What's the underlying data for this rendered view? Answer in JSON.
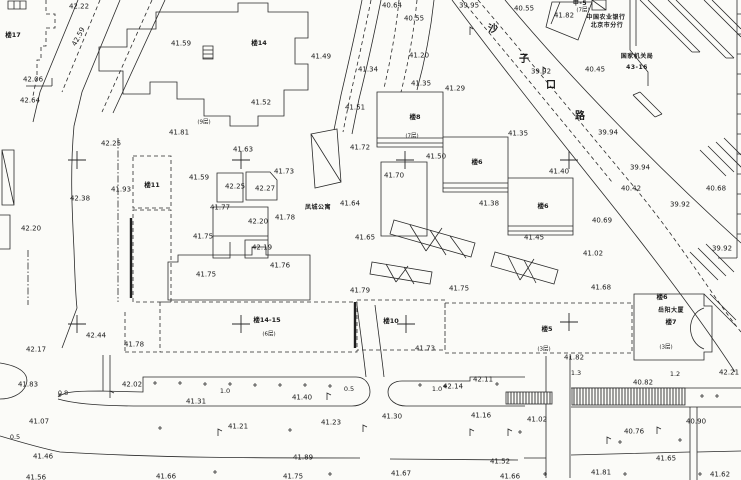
{
  "meta": {
    "kind": "scanned CAD topographic survey map",
    "background": "#fbfbf8",
    "ink": "#262626"
  },
  "map": {
    "road_name": "沙子口路",
    "labels": {
      "spot_elevations": [
        {
          "v": "42.22",
          "x": 79,
          "y": 7
        },
        {
          "v": "42.59",
          "x": 79,
          "y": 37,
          "r": -62
        },
        {
          "v": "41.59",
          "x": 181,
          "y": 44
        },
        {
          "v": "42.06",
          "x": 33,
          "y": 80
        },
        {
          "v": "42.64",
          "x": 30,
          "y": 101
        },
        {
          "v": "40.64",
          "x": 392,
          "y": 6
        },
        {
          "v": "40.55",
          "x": 414,
          "y": 19
        },
        {
          "v": "41.49",
          "x": 321,
          "y": 57
        },
        {
          "v": "41.34",
          "x": 368,
          "y": 70
        },
        {
          "v": "41.20",
          "x": 419,
          "y": 56
        },
        {
          "v": "41.52",
          "x": 261,
          "y": 103
        },
        {
          "v": "41.51",
          "x": 355,
          "y": 108
        },
        {
          "v": "41.35",
          "x": 421,
          "y": 84
        },
        {
          "v": "41.29",
          "x": 455,
          "y": 89
        },
        {
          "v": "39.95",
          "x": 469,
          "y": 6
        },
        {
          "v": "40.55",
          "x": 524,
          "y": 9
        },
        {
          "v": "41.82",
          "x": 564,
          "y": 16
        },
        {
          "v": "40.45",
          "x": 595,
          "y": 70
        },
        {
          "v": "39.92",
          "x": 541,
          "y": 72
        },
        {
          "v": "39.94",
          "x": 608,
          "y": 133
        },
        {
          "v": "39.94",
          "x": 640,
          "y": 168
        },
        {
          "v": "40.42",
          "x": 631,
          "y": 189
        },
        {
          "v": "40.68",
          "x": 716,
          "y": 189
        },
        {
          "v": "39.92",
          "x": 680,
          "y": 205
        },
        {
          "v": "40.69",
          "x": 602,
          "y": 221
        },
        {
          "v": "39.92",
          "x": 722,
          "y": 249
        },
        {
          "v": "41.02",
          "x": 593,
          "y": 254
        },
        {
          "v": "41.68",
          "x": 601,
          "y": 288
        },
        {
          "v": "42.25",
          "x": 111,
          "y": 144
        },
        {
          "v": "41.81",
          "x": 179,
          "y": 133
        },
        {
          "v": "41.63",
          "x": 243,
          "y": 150
        },
        {
          "v": "41.73",
          "x": 284,
          "y": 172
        },
        {
          "v": "41.59",
          "x": 199,
          "y": 178
        },
        {
          "v": "42.25",
          "x": 235,
          "y": 187
        },
        {
          "v": "42.27",
          "x": 265,
          "y": 189
        },
        {
          "v": "41.93",
          "x": 121,
          "y": 190
        },
        {
          "v": "42.38",
          "x": 80,
          "y": 199
        },
        {
          "v": "41.77",
          "x": 220,
          "y": 208
        },
        {
          "v": "41.64",
          "x": 350,
          "y": 204
        },
        {
          "v": "42.20",
          "x": 258,
          "y": 222
        },
        {
          "v": "41.78",
          "x": 285,
          "y": 218
        },
        {
          "v": "41.75",
          "x": 203,
          "y": 237
        },
        {
          "v": "42.19",
          "x": 262,
          "y": 248
        },
        {
          "v": "41.65",
          "x": 365,
          "y": 238
        },
        {
          "v": "41.76",
          "x": 280,
          "y": 266
        },
        {
          "v": "42.20",
          "x": 31,
          "y": 229
        },
        {
          "v": "41.72",
          "x": 360,
          "y": 148
        },
        {
          "v": "41.50",
          "x": 436,
          "y": 157
        },
        {
          "v": "41.70",
          "x": 394,
          "y": 176
        },
        {
          "v": "41.35",
          "x": 518,
          "y": 134
        },
        {
          "v": "41.40",
          "x": 559,
          "y": 172
        },
        {
          "v": "41.38",
          "x": 489,
          "y": 204
        },
        {
          "v": "41.45",
          "x": 534,
          "y": 238
        },
        {
          "v": "41.75",
          "x": 206,
          "y": 275
        },
        {
          "v": "42.44",
          "x": 96,
          "y": 336
        },
        {
          "v": "42.17",
          "x": 36,
          "y": 350
        },
        {
          "v": "41.78",
          "x": 134,
          "y": 345
        },
        {
          "v": "41.79",
          "x": 360,
          "y": 291
        },
        {
          "v": "41.75",
          "x": 459,
          "y": 289
        },
        {
          "v": "41.73",
          "x": 425,
          "y": 349
        },
        {
          "v": "41.82",
          "x": 574,
          "y": 358
        },
        {
          "v": "42.21",
          "x": 729,
          "y": 373
        },
        {
          "v": "41.83",
          "x": 28,
          "y": 385
        },
        {
          "v": "42.02",
          "x": 132,
          "y": 385
        },
        {
          "v": "41.31",
          "x": 196,
          "y": 402
        },
        {
          "v": "41.07",
          "x": 39,
          "y": 422
        },
        {
          "v": "41.21",
          "x": 238,
          "y": 427
        },
        {
          "v": "41.46",
          "x": 43,
          "y": 457
        },
        {
          "v": "41.56",
          "x": 36,
          "y": 478
        },
        {
          "v": "41.66",
          "x": 166,
          "y": 477
        },
        {
          "v": "41.40",
          "x": 302,
          "y": 398
        },
        {
          "v": "41.23",
          "x": 331,
          "y": 423
        },
        {
          "v": "41.30",
          "x": 392,
          "y": 417
        },
        {
          "v": "42.14",
          "x": 453,
          "y": 387
        },
        {
          "v": "42.11",
          "x": 483,
          "y": 380
        },
        {
          "v": "41.16",
          "x": 481,
          "y": 416
        },
        {
          "v": "41.89",
          "x": 303,
          "y": 458
        },
        {
          "v": "41.75",
          "x": 293,
          "y": 477
        },
        {
          "v": "41.67",
          "x": 401,
          "y": 474
        },
        {
          "v": "40.82",
          "x": 643,
          "y": 383
        },
        {
          "v": "41.02",
          "x": 537,
          "y": 420
        },
        {
          "v": "40.90",
          "x": 696,
          "y": 422
        },
        {
          "v": "40.76",
          "x": 634,
          "y": 432
        },
        {
          "v": "41.52",
          "x": 500,
          "y": 462
        },
        {
          "v": "41.66",
          "x": 510,
          "y": 477
        },
        {
          "v": "41.65",
          "x": 666,
          "y": 459
        },
        {
          "v": "41.81",
          "x": 601,
          "y": 473
        },
        {
          "v": "41.62",
          "x": 720,
          "y": 475
        }
      ],
      "building_numbers": [
        {
          "v": "楼17",
          "x": 13,
          "y": 35
        },
        {
          "v": "楼14",
          "x": 259,
          "y": 43
        },
        {
          "v": "楼11",
          "x": 152,
          "y": 185
        },
        {
          "v": "楼8",
          "x": 415,
          "y": 117
        },
        {
          "v": "楼6",
          "x": 477,
          "y": 162
        },
        {
          "v": "楼6",
          "x": 543,
          "y": 206
        },
        {
          "v": "楼14-15",
          "x": 267,
          "y": 320
        },
        {
          "v": "楼10",
          "x": 391,
          "y": 321
        },
        {
          "v": "楼5",
          "x": 547,
          "y": 329
        },
        {
          "v": "楼6",
          "x": 662,
          "y": 297
        },
        {
          "v": "楼7",
          "x": 671,
          "y": 322
        }
      ],
      "place_names": [
        {
          "v": "凤城公寓",
          "x": 318,
          "y": 208
        },
        {
          "v": "岳阳大厦",
          "x": 671,
          "y": 311
        },
        {
          "v": "中国农业银行",
          "x": 606,
          "y": 18
        },
        {
          "v": "北京市分行",
          "x": 607,
          "y": 26
        },
        {
          "v": "国家机关局",
          "x": 637,
          "y": 57
        },
        {
          "v": "43-16",
          "x": 637,
          "y": 68
        },
        {
          "v": "甲-5",
          "x": 580,
          "y": 4
        }
      ],
      "storey_notes": [
        {
          "v": "(9层)",
          "x": 204,
          "y": 123
        },
        {
          "v": "(7层)",
          "x": 583,
          "y": 11
        },
        {
          "v": "(7层)",
          "x": 412,
          "y": 137
        },
        {
          "v": "(6层)",
          "x": 269,
          "y": 335
        },
        {
          "v": "(3层)",
          "x": 544,
          "y": 350
        },
        {
          "v": "(3层)",
          "x": 666,
          "y": 348
        }
      ],
      "road_widths": [
        {
          "v": "0.8",
          "x": 63,
          "y": 393
        },
        {
          "v": "1.0",
          "x": 225,
          "y": 391
        },
        {
          "v": "0.5",
          "x": 15,
          "y": 437
        },
        {
          "v": "0.5",
          "x": 349,
          "y": 389
        },
        {
          "v": "1.0",
          "x": 437,
          "y": 389
        },
        {
          "v": "1.3",
          "x": 576,
          "y": 373
        },
        {
          "v": "1.2",
          "x": 675,
          "y": 374
        }
      ],
      "road_name_chars": [
        {
          "v": "沙",
          "x": 493,
          "y": 30
        },
        {
          "v": "子",
          "x": 524,
          "y": 60
        },
        {
          "v": "口",
          "x": 551,
          "y": 86
        },
        {
          "v": "路",
          "x": 580,
          "y": 117
        }
      ]
    },
    "grid_crosses": [
      [
        77,
        160
      ],
      [
        241,
        160
      ],
      [
        405,
        160
      ],
      [
        569,
        160
      ],
      [
        77,
        324
      ],
      [
        241,
        324
      ],
      [
        406,
        324
      ],
      [
        569,
        322
      ]
    ]
  }
}
